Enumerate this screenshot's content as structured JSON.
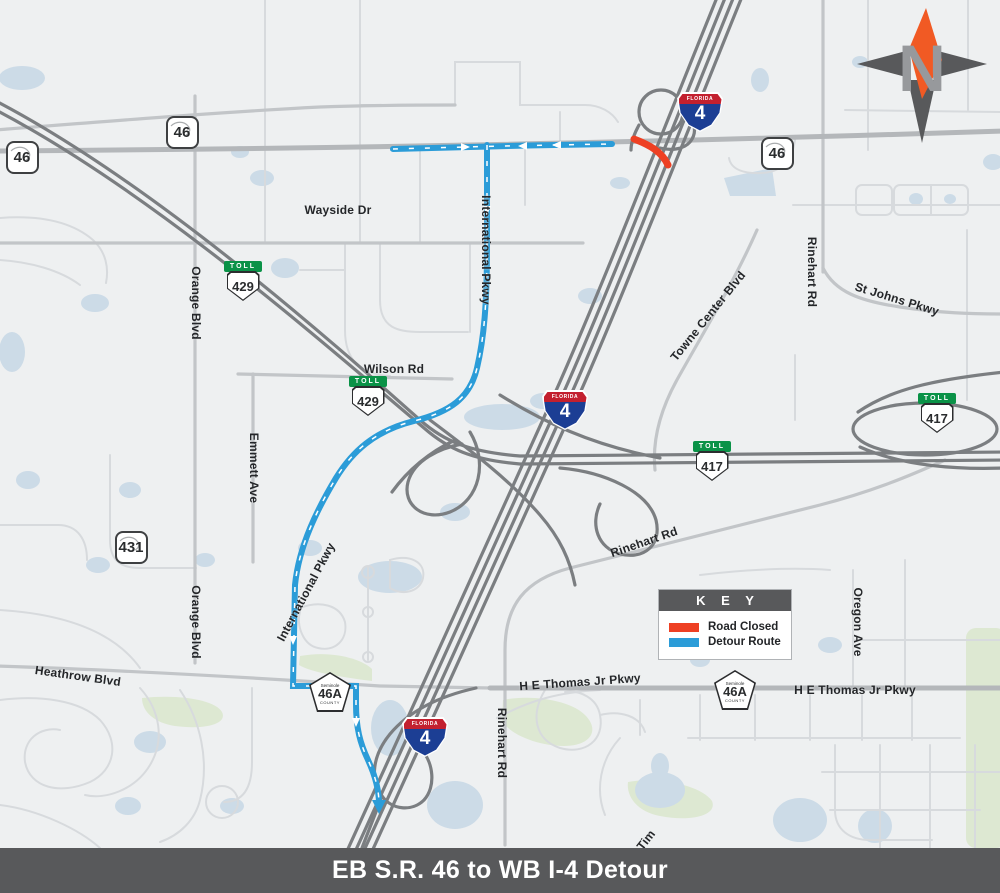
{
  "page": {
    "title": "EB S.R. 46 to WB I-4 Detour"
  },
  "legend": {
    "header": "K E Y",
    "items": [
      {
        "label": "Road Closed",
        "color": "#ee4023"
      },
      {
        "label": "Detour Route",
        "color": "#2b9cd8"
      }
    ]
  },
  "compass": {
    "letter": "N"
  },
  "colors": {
    "map_background": "#eef0f1",
    "water": "#ccdbe7",
    "park_green": "#dde8d2",
    "minor_road": "#d7dadd",
    "medium_road": "#c2c5c8",
    "primary_road": "#b4b7ba",
    "highway": "#7b7e81",
    "road_closed": "#ee4023",
    "detour_route": "#2b9cd8",
    "titlebar_background": "#58595b"
  },
  "labels": [
    {
      "text": "Wayside Dr"
    },
    {
      "text": "Wilson Rd"
    },
    {
      "text": "Orange Blvd"
    },
    {
      "text": "Orange Blvd"
    },
    {
      "text": "Emmett Ave"
    },
    {
      "text": "International Pkwy"
    },
    {
      "text": "International Pkwy"
    },
    {
      "text": "Towne Center Blvd"
    },
    {
      "text": "Rinehart Rd"
    },
    {
      "text": "St Johns Pkwy"
    },
    {
      "text": "Rinehart Rd"
    },
    {
      "text": "Rinehart Rd"
    },
    {
      "text": "Heathrow Blvd"
    },
    {
      "text": "H E Thomas Jr Pkwy"
    },
    {
      "text": "H E Thomas Jr Pkwy"
    },
    {
      "text": "Oregon Ave"
    },
    {
      "text": "Tim"
    }
  ],
  "markers": [
    {
      "type": "state",
      "label": "46"
    },
    {
      "type": "state",
      "label": "46"
    },
    {
      "type": "state",
      "label": "46"
    },
    {
      "type": "toll",
      "banner": "TOLL",
      "label": "429"
    },
    {
      "type": "toll",
      "banner": "TOLL",
      "label": "429"
    },
    {
      "type": "state",
      "label": "431"
    },
    {
      "type": "toll",
      "banner": "TOLL",
      "label": "417"
    },
    {
      "type": "toll",
      "banner": "TOLL",
      "label": "417"
    },
    {
      "type": "interstate",
      "banner": "FLORIDA",
      "label": "4"
    },
    {
      "type": "interstate",
      "banner": "FLORIDA",
      "label": "4"
    },
    {
      "type": "interstate",
      "banner": "FLORIDA",
      "label": "4"
    },
    {
      "type": "county",
      "top": "Seminole",
      "label": "46A",
      "bottom": "COUNTY"
    },
    {
      "type": "county",
      "top": "Seminole",
      "label": "46A",
      "bottom": "COUNTY"
    }
  ]
}
